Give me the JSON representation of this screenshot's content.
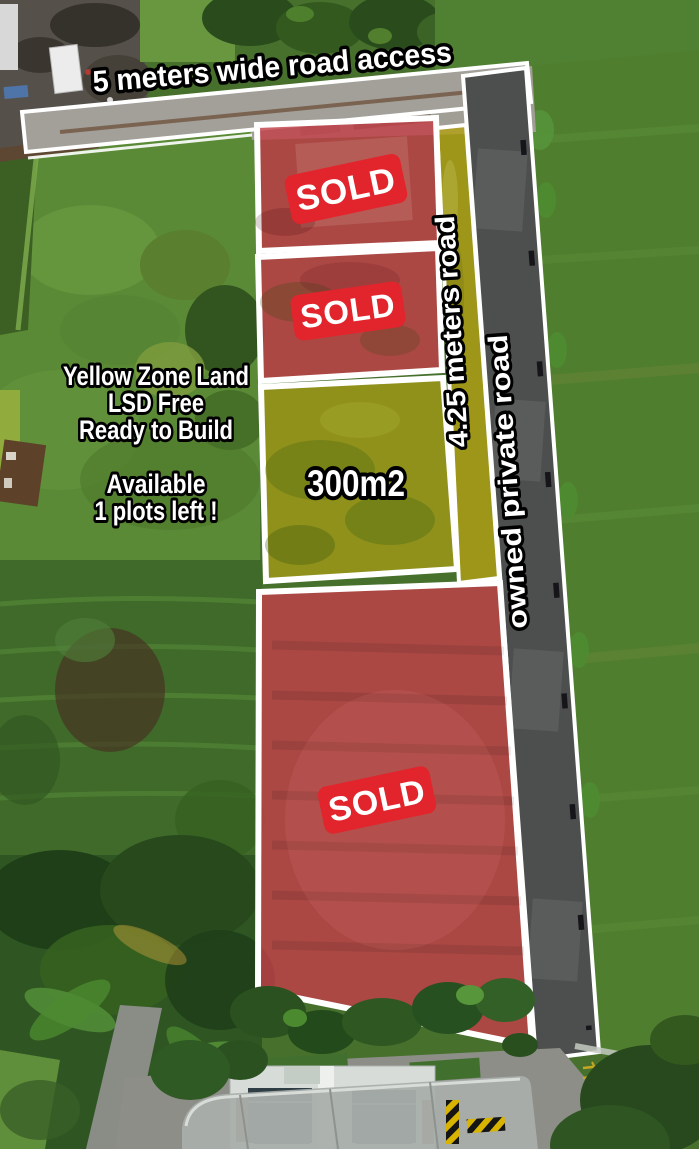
{
  "annotations": {
    "access_road": "5 meters wide road access",
    "zone_road": "4.25 meters road",
    "private_road": "owned private road"
  },
  "info_panel": {
    "lines": [
      "Yellow Zone Land",
      "LSD Free",
      "Ready to Build",
      "",
      "Available",
      "1 plots left !"
    ]
  },
  "plots": [
    {
      "name": "plot-1",
      "status_label": "SOLD"
    },
    {
      "name": "plot-2",
      "status_label": "SOLD"
    },
    {
      "name": "plot-3",
      "area_label": "300m2"
    },
    {
      "name": "plot-4",
      "status_label": "SOLD"
    }
  ],
  "colors": {
    "sold_overlay": "#c24049",
    "sold_badge": "#e2252c",
    "available_overlay": "#b2a013",
    "zone_road_fill": "#b3a014",
    "private_road_fill": "#4c4f4e",
    "access_road_fill": "#a3a09a",
    "plot_border": "#ffffff"
  }
}
